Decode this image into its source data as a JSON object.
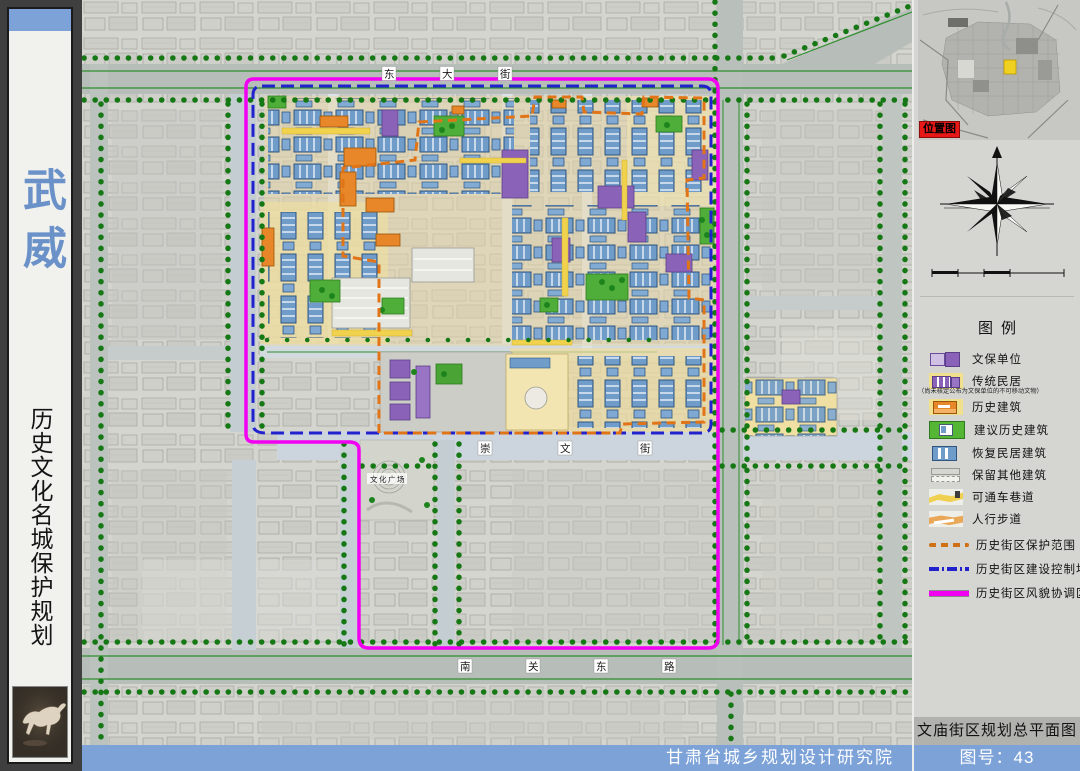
{
  "sidebar": {
    "city": "武威",
    "title": "历史文化名城保护规划"
  },
  "map": {
    "roads": {
      "top": "东大街",
      "middle": "崇文街",
      "bottom": "南关东路"
    },
    "places": {
      "square": "文化广场"
    }
  },
  "inset": {
    "label": "位置图"
  },
  "legend": {
    "title": "图例",
    "items": [
      {
        "label": "文保单位"
      },
      {
        "label": "传统民居",
        "note": "（尚未核定公布为文保单位的不可移动文物）"
      },
      {
        "label": "历史建筑"
      },
      {
        "label": "建议历史建筑"
      },
      {
        "label": "恢复民居建筑"
      },
      {
        "label": "保留其他建筑"
      },
      {
        "label": "可通车巷道"
      },
      {
        "label": "人行步道"
      },
      {
        "label": "历史街区保护范围"
      },
      {
        "label": "历史街区建设控制地带"
      },
      {
        "label": "历史街区风貌协调区"
      }
    ]
  },
  "footer": {
    "institute": "甘肃省城乡规划设计研究院",
    "drawing_title": "文庙街区规划总平面图",
    "drawing_number": "图号：43"
  },
  "colors": {
    "accent_blue": "#7ca2d8",
    "boundary_magenta": "#f100f1",
    "boundary_blue": "#2121cd",
    "boundary_orange": "#e07417",
    "building_blue": "#6f9cc9",
    "building_purple": "#8a62b8",
    "building_orange": "#e8862a",
    "building_green": "#4aa435",
    "marker_red": "#e81818",
    "marker_yellow": "#f0d020"
  }
}
